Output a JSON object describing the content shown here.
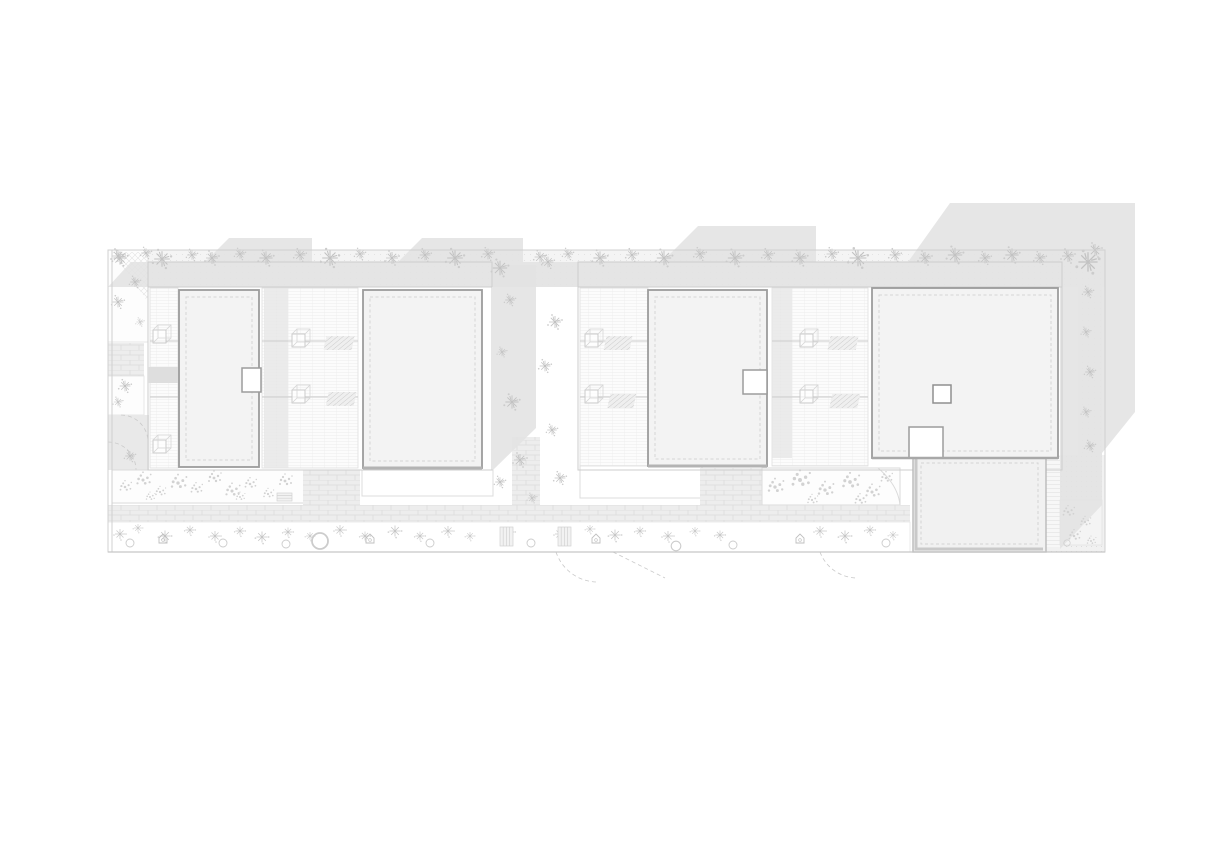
{
  "meta": {
    "width": 1221,
    "height": 848
  },
  "colors": {
    "background": "#ffffff",
    "shadow": "#e2e2e2",
    "roof_fill": "#f3f3f3",
    "roof_border": "#9c9c9c",
    "line_light": "#dcdcdc",
    "line_mid": "#c6c6c6",
    "vegetation": "#bdbdbd",
    "paving": "#ececec"
  },
  "zones": {
    "top_planting_band": "roof terrace planting band",
    "block1": "west building block",
    "block2": "east building block",
    "courtyard": "garden corridor between blocks",
    "walkway": "brick walkway",
    "bottom_planting_strip": "street planting strip",
    "annex": "lower annex roof",
    "right_strip": "east edge planting strip"
  },
  "vegetation": {
    "plants_top": [
      [
        118,
        256,
        1.0
      ],
      [
        146,
        253,
        0.8
      ],
      [
        162,
        259,
        1.3
      ],
      [
        192,
        255,
        0.8
      ],
      [
        212,
        258,
        1.0
      ],
      [
        240,
        254,
        0.8
      ],
      [
        266,
        258,
        1.1
      ],
      [
        300,
        255,
        0.9
      ],
      [
        330,
        258,
        1.3
      ],
      [
        360,
        254,
        0.8
      ],
      [
        392,
        258,
        1.0
      ],
      [
        425,
        255,
        0.9
      ],
      [
        455,
        258,
        1.3
      ],
      [
        488,
        254,
        0.9
      ],
      [
        540,
        257,
        0.9
      ],
      [
        568,
        254,
        0.8
      ],
      [
        600,
        258,
        1.1
      ],
      [
        632,
        255,
        0.9
      ],
      [
        664,
        258,
        1.2
      ],
      [
        700,
        254,
        0.9
      ],
      [
        735,
        258,
        1.2
      ],
      [
        768,
        255,
        0.9
      ],
      [
        800,
        258,
        1.1
      ],
      [
        832,
        254,
        0.9
      ],
      [
        858,
        258,
        1.4
      ],
      [
        895,
        255,
        0.9
      ],
      [
        925,
        258,
        1.0
      ],
      [
        955,
        255,
        1.2
      ],
      [
        985,
        258,
        0.9
      ],
      [
        1012,
        255,
        1.1
      ],
      [
        1040,
        258,
        0.9
      ],
      [
        1068,
        256,
        1.0
      ],
      [
        1088,
        262,
        1.6
      ],
      [
        1095,
        250,
        1.0
      ]
    ],
    "plants_corridor": [
      [
        500,
        268,
        1.2
      ],
      [
        548,
        262,
        0.9
      ],
      [
        510,
        300,
        0.8
      ],
      [
        555,
        322,
        1.0
      ],
      [
        502,
        352,
        0.7
      ],
      [
        545,
        366,
        0.9
      ],
      [
        512,
        402,
        1.1
      ],
      [
        552,
        430,
        0.8
      ],
      [
        520,
        460,
        1.0
      ],
      [
        500,
        482,
        0.8
      ],
      [
        560,
        478,
        0.9
      ],
      [
        532,
        498,
        0.7
      ]
    ],
    "plants_leftcol": [
      [
        120,
        258,
        1.1
      ],
      [
        135,
        282,
        0.8
      ],
      [
        118,
        302,
        0.9
      ],
      [
        140,
        322,
        0.6
      ],
      [
        125,
        386,
        0.9
      ],
      [
        118,
        402,
        0.7
      ],
      [
        130,
        456,
        0.8
      ]
    ],
    "flowers_bed1": [
      [
        125,
        487,
        0.9
      ],
      [
        143,
        480,
        1.1
      ],
      [
        160,
        492,
        0.8
      ],
      [
        178,
        483,
        1.2
      ],
      [
        196,
        489,
        0.9
      ],
      [
        214,
        478,
        1.0
      ],
      [
        232,
        491,
        1.1
      ],
      [
        250,
        484,
        0.9
      ],
      [
        268,
        494,
        0.8
      ],
      [
        285,
        481,
        1.0
      ],
      [
        150,
        497,
        0.7
      ],
      [
        240,
        497,
        0.7
      ]
    ],
    "flowers_bed2": [
      [
        775,
        487,
        1.2
      ],
      [
        800,
        480,
        1.4
      ],
      [
        825,
        490,
        1.2
      ],
      [
        850,
        482,
        1.3
      ],
      [
        872,
        492,
        1.1
      ],
      [
        886,
        478,
        0.9
      ],
      [
        812,
        500,
        0.8
      ],
      [
        860,
        500,
        0.9
      ]
    ],
    "shrubs_bottom": [
      [
        120,
        534,
        1.0
      ],
      [
        138,
        528,
        0.8
      ],
      [
        165,
        536,
        1.1
      ],
      [
        190,
        530,
        0.9
      ],
      [
        215,
        536,
        1.0
      ],
      [
        240,
        531,
        0.9
      ],
      [
        262,
        537,
        1.1
      ],
      [
        288,
        532,
        0.9
      ],
      [
        310,
        536,
        0.8
      ],
      [
        340,
        530,
        1.0
      ],
      [
        365,
        536,
        0.9
      ],
      [
        395,
        531,
        1.1
      ],
      [
        420,
        536,
        0.9
      ],
      [
        448,
        531,
        1.0
      ],
      [
        470,
        536,
        0.8
      ],
      [
        510,
        532,
        0.9
      ],
      [
        560,
        534,
        1.0
      ],
      [
        590,
        529,
        0.8
      ],
      [
        615,
        535,
        1.1
      ],
      [
        640,
        531,
        0.9
      ],
      [
        668,
        536,
        1.0
      ],
      [
        695,
        531,
        0.8
      ],
      [
        720,
        535,
        0.9
      ],
      [
        820,
        531,
        1.0
      ],
      [
        845,
        536,
        1.1
      ],
      [
        870,
        530,
        0.9
      ],
      [
        893,
        535,
        0.8
      ]
    ],
    "plants_rightstrip": [
      [
        1088,
        292,
        0.8
      ],
      [
        1086,
        332,
        0.7
      ],
      [
        1090,
        372,
        0.8
      ],
      [
        1086,
        412,
        0.7
      ],
      [
        1090,
        446,
        0.8
      ]
    ],
    "plants_rightsquare": [
      [
        1068,
        512,
        0.9
      ],
      [
        1085,
        522,
        0.8
      ],
      [
        1074,
        536,
        0.9
      ],
      [
        1091,
        541,
        0.7
      ]
    ],
    "tree_circles": [
      [
        130,
        543,
        1.0
      ],
      [
        223,
        543,
        1.0
      ],
      [
        286,
        544,
        1.0
      ],
      [
        320,
        541,
        2.0
      ],
      [
        430,
        543,
        1.0
      ],
      [
        531,
        543,
        1.0
      ],
      [
        676,
        546,
        1.2
      ],
      [
        733,
        545,
        1.0
      ],
      [
        886,
        543,
        1.0
      ],
      [
        1067,
        543,
        0.8
      ]
    ],
    "houses": [
      [
        163,
        539,
        1.0
      ],
      [
        370,
        539,
        1.0
      ],
      [
        596,
        539,
        1.0
      ],
      [
        800,
        539,
        1.0
      ]
    ],
    "benches_h": [
      [
        277,
        493,
        1.0
      ]
    ],
    "benches_v": [
      [
        500,
        527,
        1.0
      ],
      [
        558,
        527,
        1.0
      ]
    ]
  }
}
